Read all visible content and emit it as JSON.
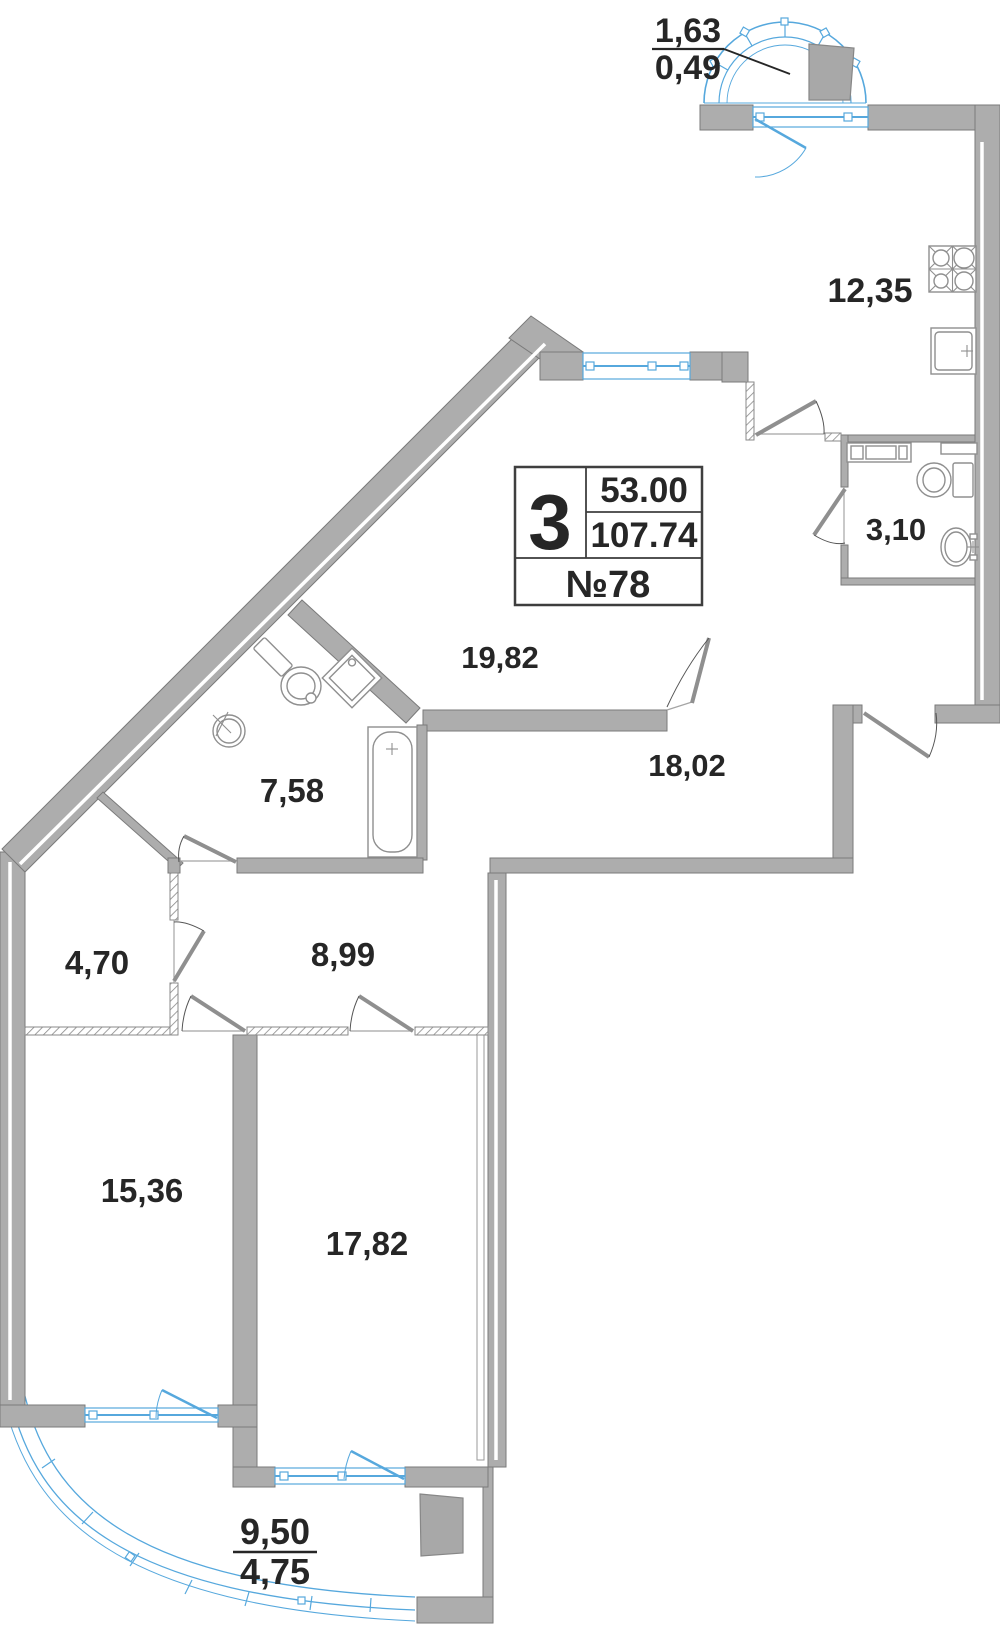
{
  "info_box": {
    "rooms": "3",
    "living_area": "53.00",
    "total_area": "107.74",
    "apartment": "№78"
  },
  "rooms": {
    "kitchen": "12,35",
    "wc_small": "3,10",
    "living": "19,82",
    "hall": "18,02",
    "bathroom": "7,58",
    "corridor": "8,99",
    "wardrobe": "4,70",
    "bedroom_left": "15,36",
    "bedroom_right": "17,82"
  },
  "balcony_top": {
    "area_full": "1,63",
    "area_reduced": "0,49"
  },
  "balcony_bottom": {
    "area_full": "9,50",
    "area_reduced": "4,75"
  },
  "colors": {
    "wall": "#adadad",
    "glazing": "#56a8dd",
    "text": "#262626",
    "box_bg": "#d8d8d8"
  }
}
